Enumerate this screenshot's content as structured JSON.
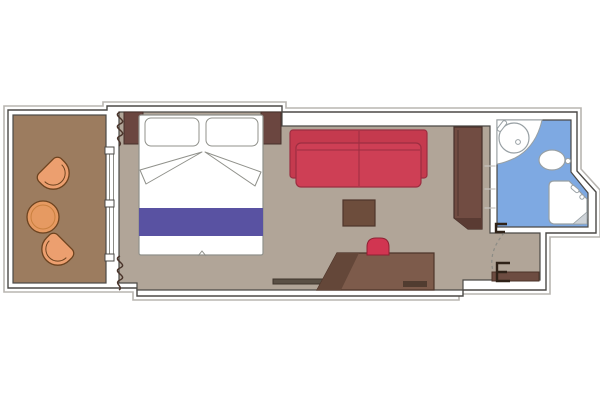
{
  "plan": {
    "type": "cruise-cabin-floor-plan",
    "rooms": [
      {
        "name": "balcony",
        "items": [
          "tub-armchair",
          "tub-armchair",
          "round-table"
        ]
      },
      {
        "name": "cabin",
        "items": [
          "double-bed",
          "pillow",
          "pillow",
          "bed-runner",
          "nightstand",
          "nightstand",
          "curtains",
          "sliding-glass-door",
          "sofa",
          "coffee-table",
          "desk",
          "desk-chair",
          "low-shelf",
          "wardrobe"
        ]
      },
      {
        "name": "bathroom",
        "items": [
          "counter",
          "washbasin",
          "faucet",
          "toilet",
          "shower",
          "shower-glass"
        ]
      },
      {
        "name": "entrance",
        "items": [
          "entry-door",
          "door-swing",
          "door-handle",
          "door-handle"
        ]
      }
    ]
  },
  "colors": {
    "outline": "#b8b5b1",
    "wall_fill": "#ffffff",
    "wall_stroke": "#4b4946",
    "balcony_floor": "#9c7c5f",
    "cabin_floor": "#b1a598",
    "bathroom_floor": "#7ea9e2",
    "window_line": "#8b8b85",
    "curtain": "#4a342b",
    "dark_wood": "#6b4640",
    "wardrobe_wood": "#714c42",
    "wardrobe_dark": "#5a3b33",
    "desk_wood": "#7d5b4b",
    "desk_shadow": "#644739",
    "desk_strip": "#513c30",
    "table_wood": "#6d4d3c",
    "table_stroke": "#4e352a",
    "shelf_bar": "#5a5045",
    "shelf_bar_stroke": "#3e352c",
    "sofa_back": "#c53a4e",
    "sofa_seat": "#ce3f55",
    "sofa_stroke": "#9c2e41",
    "chair_red": "#d13551",
    "chair_red_stroke": "#8e2133",
    "bed_fill": "#ffffff",
    "bed_stroke": "#90918b",
    "bed_runner": "#5952a2",
    "fixture_stroke": "#98a0a4",
    "glass_gray": "#ced3d8",
    "balcony_chair": "#ec9f6f",
    "balcony_table": "#e69a62",
    "balcony_furniture_stroke": "#6d431f",
    "balcony_table_ring": "#c9803f",
    "door_wood": "#6d4c41",
    "door_wood_stroke": "#4a3227",
    "handle": "#2f2218",
    "shelf_line": "#c6c3bf",
    "wood_stroke": "#46302a"
  }
}
